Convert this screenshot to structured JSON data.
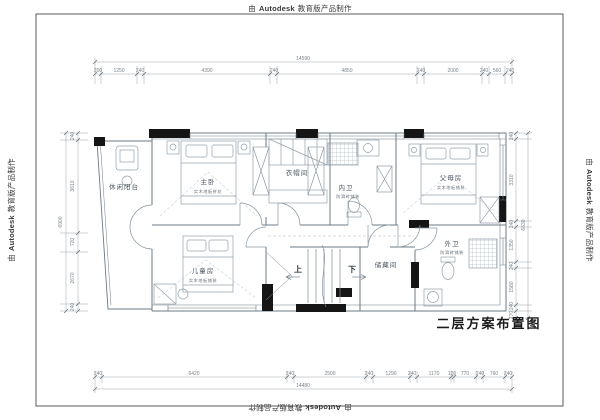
{
  "watermark": {
    "prefix": "由",
    "brand": "Autodesk",
    "suffix": "教育版产品制作"
  },
  "title": "二层方案布置图",
  "rooms": {
    "balcony": {
      "name": "休闲阳台"
    },
    "master": {
      "name": "主卧",
      "finish": "实木地板拼花"
    },
    "cloak": {
      "name": "衣帽间"
    },
    "inner_bath": {
      "name": "内卫",
      "finish": "防滑砖铺装"
    },
    "parents": {
      "name": "父母房",
      "finish": "实木地板铺装"
    },
    "kids": {
      "name": "儿童房",
      "finish": "实木地板铺装"
    },
    "storage": {
      "name": "储藏间"
    },
    "outer_bath": {
      "name": "外卫",
      "finish": "防滑砖铺装"
    }
  },
  "stairs": {
    "up": "上",
    "down": "下"
  },
  "dimensions": {
    "top": {
      "total": "14590",
      "segments": [
        "200",
        "1250",
        "240",
        "4390",
        "240",
        "4850",
        "240",
        "2000",
        "240",
        "560",
        "240"
      ]
    },
    "bottom": {
      "total": "14480",
      "segments": [
        "240",
        "6420",
        "240",
        "2500",
        "240",
        "1290",
        "240",
        "1170",
        "120",
        "770",
        "240",
        "760",
        "240"
      ]
    },
    "left": {
      "total": "6900",
      "segments": [
        "240",
        "3610",
        "720",
        "2670",
        "240"
      ]
    },
    "right": {
      "total": "6630",
      "segments": [
        "240",
        "3310",
        "240",
        "1350",
        "240",
        "1580",
        "240",
        "270"
      ]
    }
  },
  "colors": {
    "line": "#6b7a86",
    "furniture": "#93a1ab",
    "wallfill": "#151515",
    "dimline": "#9aa4ab"
  }
}
